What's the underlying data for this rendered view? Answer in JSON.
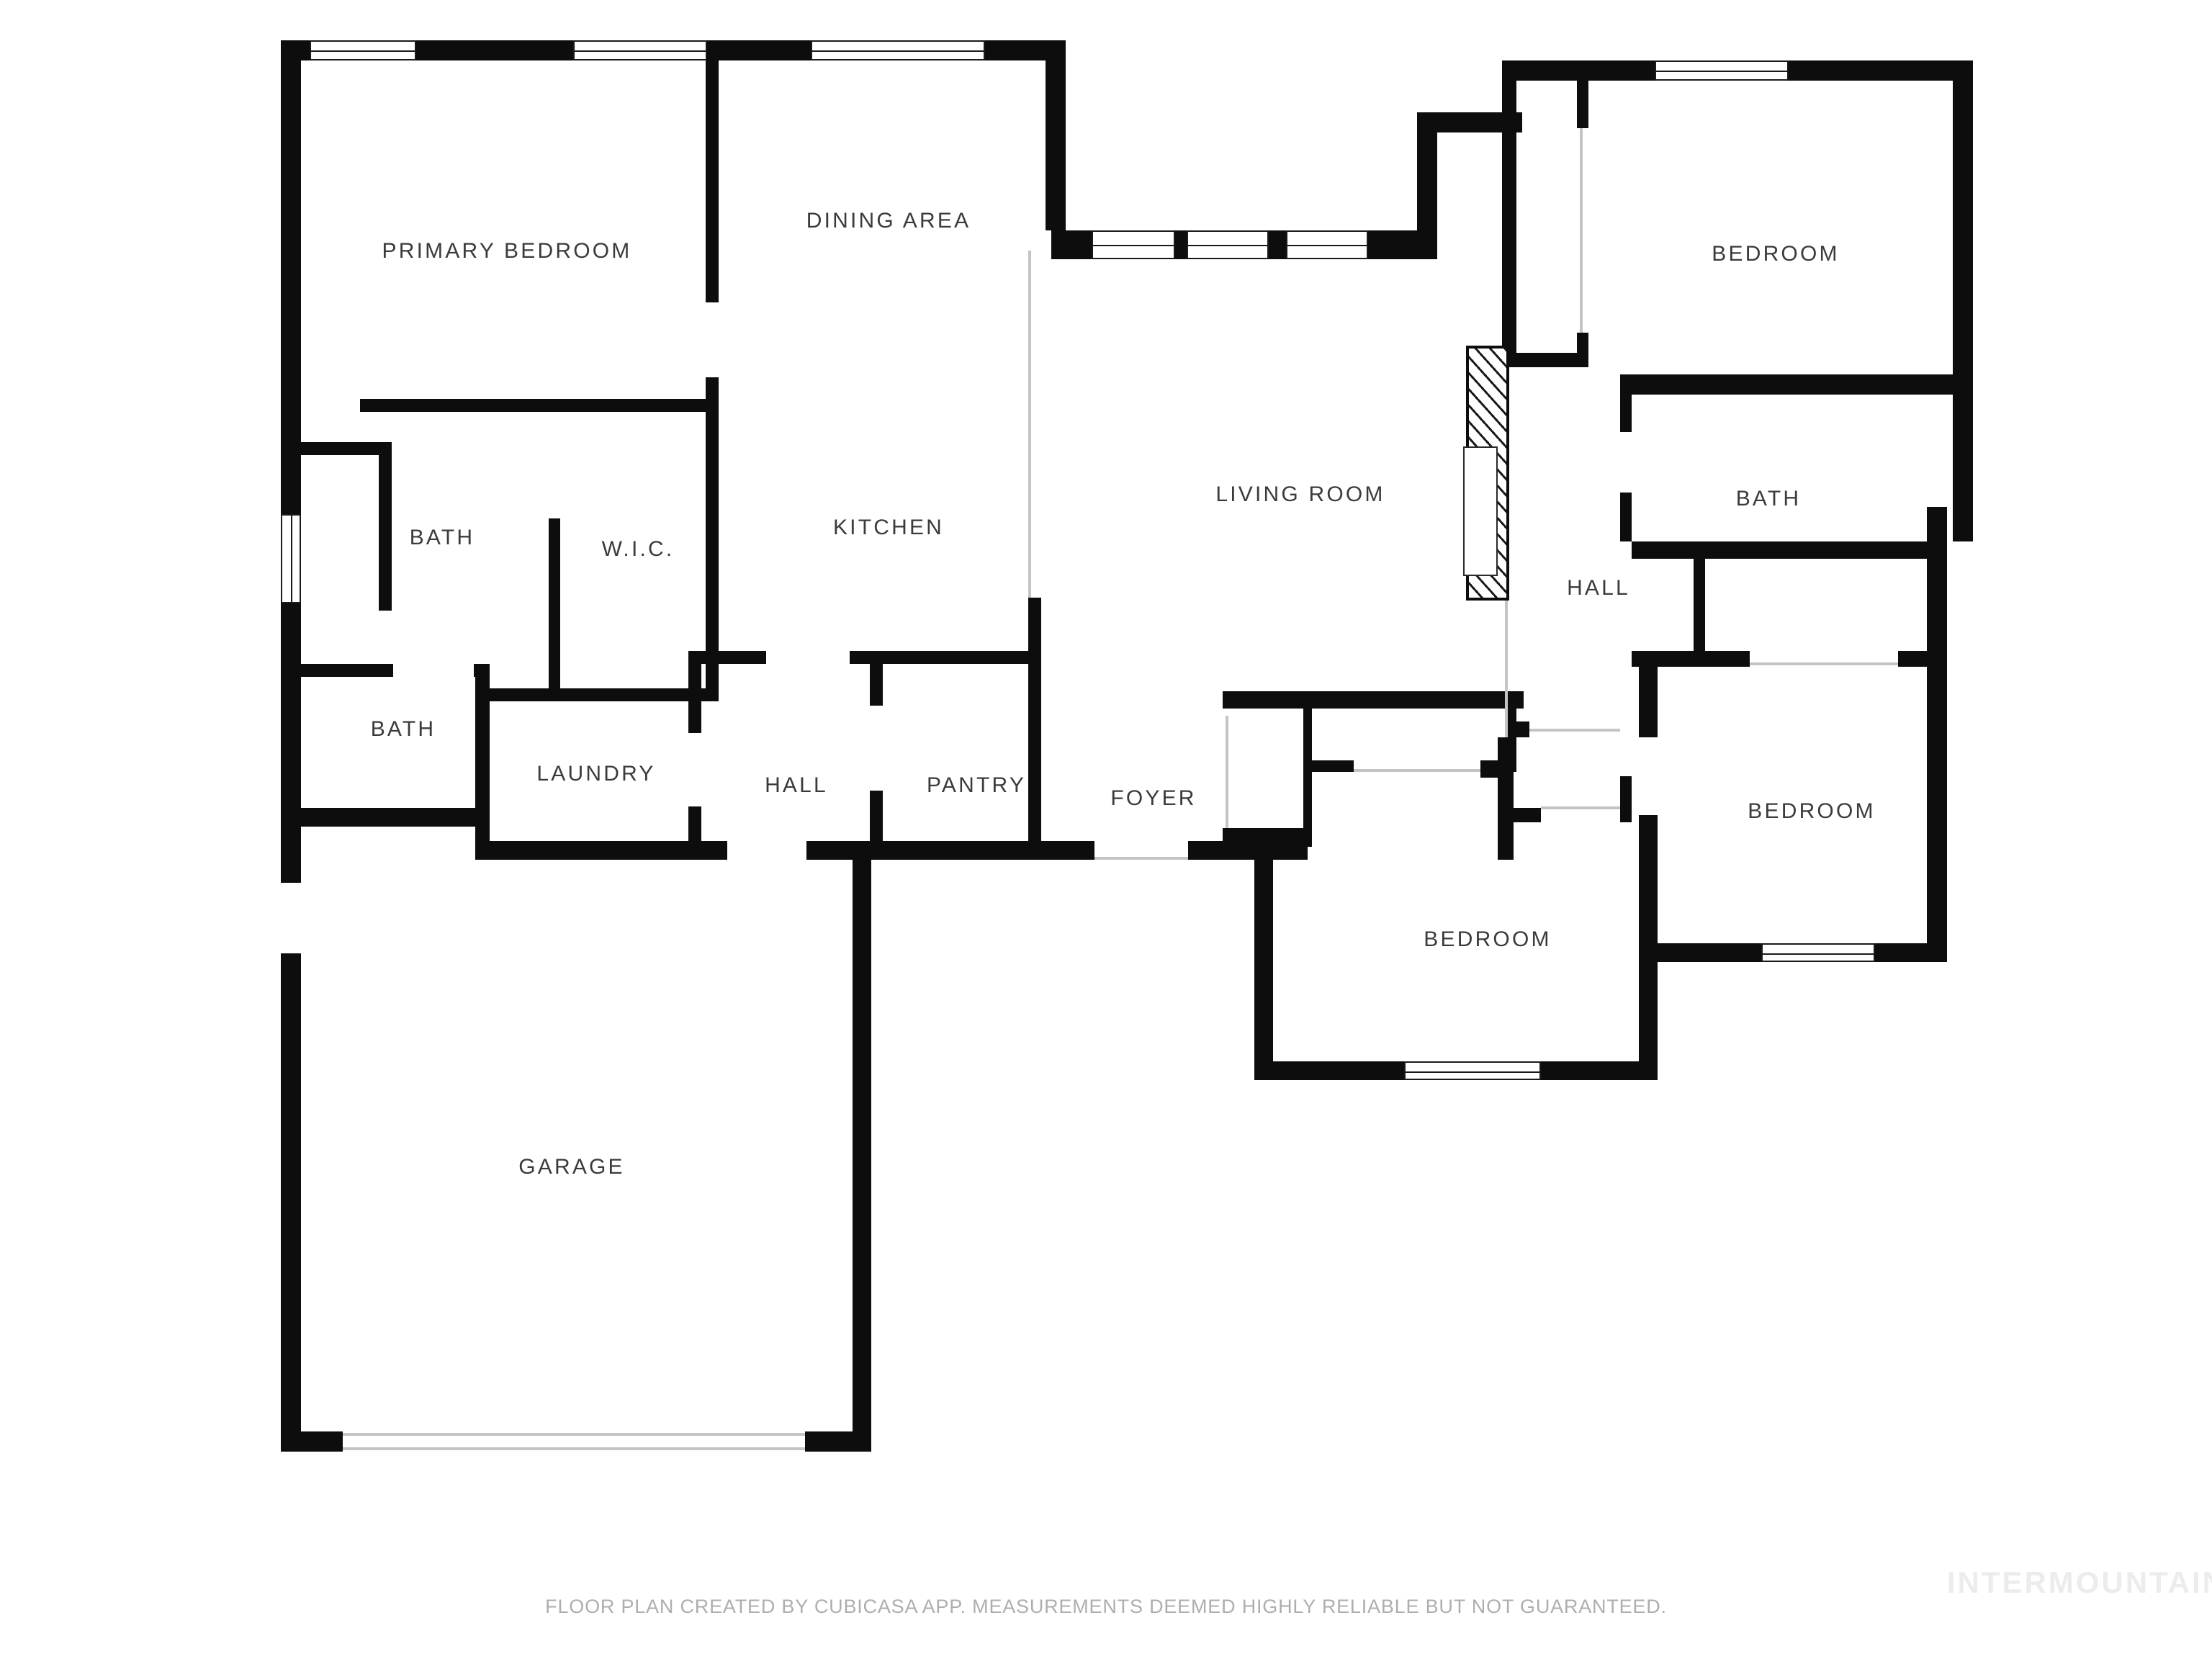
{
  "floor_plan": {
    "title": "Single-story residential floor plan",
    "rooms": [
      {
        "id": "primary-bedroom",
        "label": "PRIMARY BEDROOM"
      },
      {
        "id": "dining-area",
        "label": "DINING AREA"
      },
      {
        "id": "bedroom-top-right",
        "label": "BEDROOM"
      },
      {
        "id": "bath-primary",
        "label": "BATH"
      },
      {
        "id": "wic",
        "label": "W.I.C."
      },
      {
        "id": "kitchen",
        "label": "KITCHEN"
      },
      {
        "id": "living-room",
        "label": "LIVING ROOM"
      },
      {
        "id": "hall-right",
        "label": "HALL"
      },
      {
        "id": "bath-right",
        "label": "BATH"
      },
      {
        "id": "bath-second",
        "label": "BATH"
      },
      {
        "id": "laundry",
        "label": "LAUNDRY"
      },
      {
        "id": "hall-center",
        "label": "HALL"
      },
      {
        "id": "pantry",
        "label": "PANTRY"
      },
      {
        "id": "foyer",
        "label": "FOYER"
      },
      {
        "id": "bedroom-bottom-middle",
        "label": "BEDROOM"
      },
      {
        "id": "bedroom-right",
        "label": "BEDROOM"
      },
      {
        "id": "garage",
        "label": "GARAGE"
      }
    ],
    "footer": {
      "disclaimer": "FLOOR PLAN CREATED BY CUBICASA APP. MEASUREMENTS DEEMED HIGHLY RELIABLE BUT NOT GUARANTEED."
    },
    "watermark": "INTERMOUNTAIN",
    "colors": {
      "walls": "#0d0d0d",
      "labels": "#3b3b3b",
      "footer_text": "#aeaeae",
      "watermark_text": "#ececec",
      "open_boundary_line": "#c4c4c4",
      "background": "#ffffff"
    },
    "features": {
      "windows": 9,
      "door_openings": "white gaps in walls",
      "stair_hatch": "diagonal-hatched feature on living room right wall",
      "garage_door": "wide opening in garage bottom wall with thin jamb lines",
      "front_door": "opening in foyer bottom wall"
    }
  }
}
